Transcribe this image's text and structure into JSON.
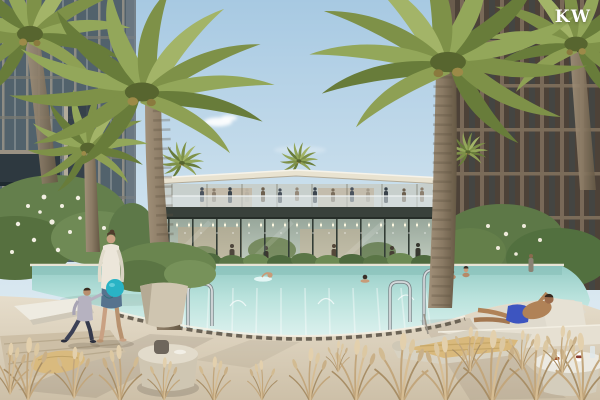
{
  "watermark": {
    "text": "KW",
    "color": "#ffffff"
  },
  "scene": {
    "type": "architectural rendering",
    "description": "Resort-style swimming pool courtyard between two residential high-rise towers, with a two-storey glass clubhouse with rooftop terrace, tall date palms, sun loungers and people relaxing",
    "palette": {
      "sky": "#a7c9e2",
      "pool_water": "#bfe6e1",
      "pool_deck": "#ddd3c0",
      "palm_green": "#7e9148",
      "canopy_roof": "#e9e3d1",
      "clubhouse_fascia": "#39413b",
      "balloon_teal": "#29b3c5",
      "denim_skirt": "#56738e",
      "swim_shorts": "#3d55c0",
      "dry_grass": "#c2a67c"
    },
    "objects": [
      "left residential tower",
      "right residential tower",
      "clubhouse with rooftop terrace",
      "swimming pool with fountain jets",
      "date palm trees",
      "woman walking with child",
      "teal balloon",
      "man reclining on pool-edge lounger",
      "swimmers in pool",
      "sun loungers and daybeds",
      "round side tables with plates",
      "pool handrails",
      "frangipani shrubs with white blossoms",
      "patio umbrella",
      "ornamental dry grasses"
    ]
  }
}
